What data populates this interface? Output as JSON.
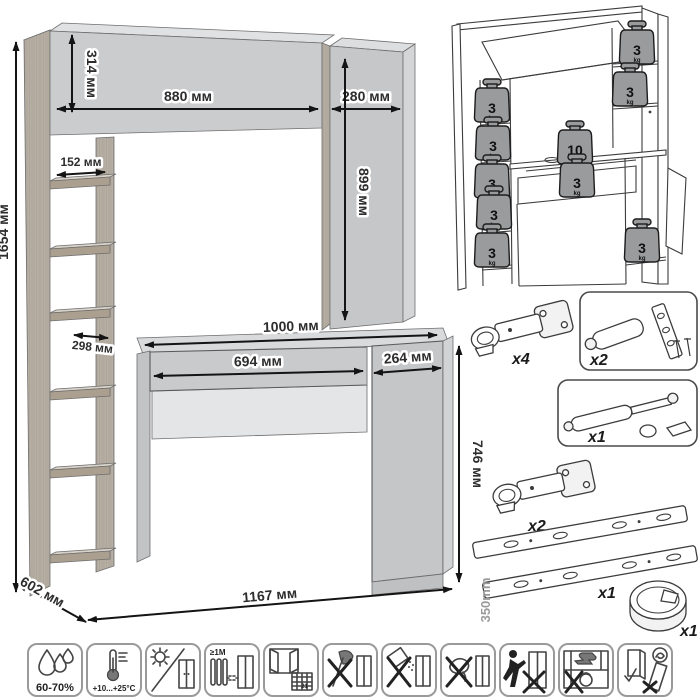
{
  "dimension_diagram": {
    "labels": {
      "total_height": "1654 мм",
      "bridge_height": "314 мм",
      "bridge_width": "880 мм",
      "right_cabinet_width": "280 мм",
      "right_cabinet_height": "899 мм",
      "shelf_width": "152 мм",
      "desktop_width": "1000 мм",
      "shelf_depth": "298 мм",
      "drawer_width": "694 мм",
      "pedestal_width": "264 мм",
      "desk_height": "746 мм",
      "depth": "602 мм",
      "total_width": "1167 мм"
    }
  },
  "load_diagram": {
    "weights": [
      {
        "value": "3",
        "unit": "kg"
      },
      {
        "value": "3",
        "unit": "kg"
      },
      {
        "value": "3",
        "unit": "kg"
      },
      {
        "value": "3",
        "unit": "kg"
      },
      {
        "value": "3",
        "unit": "kg"
      },
      {
        "value": "3",
        "unit": "kg"
      },
      {
        "value": "3",
        "unit": "kg"
      },
      {
        "value": "10",
        "unit": "kg"
      },
      {
        "value": "3",
        "unit": "kg"
      },
      {
        "value": "3",
        "unit": "kg"
      }
    ]
  },
  "hardware": {
    "items": [
      {
        "id": "hinge-top",
        "qty": "x4"
      },
      {
        "id": "door-damper",
        "qty": "x2"
      },
      {
        "id": "gas-lift",
        "qty": "x1"
      },
      {
        "id": "hinge-bottom",
        "qty": "x2"
      },
      {
        "id": "drawer-slides",
        "qty": "x1",
        "length": "350mm"
      },
      {
        "id": "cable-grommet",
        "qty": "x1"
      }
    ]
  },
  "care_icons": [
    {
      "id": "humidity",
      "label": "60-70%"
    },
    {
      "id": "temperature",
      "label": "+10...+25°C"
    },
    {
      "id": "no-direct-sunlight",
      "label": ""
    },
    {
      "id": "heat-distance",
      "label": "≥1М"
    },
    {
      "id": "ventilation",
      "label": "21"
    },
    {
      "id": "no-sharp-impact",
      "label": ""
    },
    {
      "id": "no-abrasives",
      "label": ""
    },
    {
      "id": "no-wet-cleaning",
      "label": ""
    },
    {
      "id": "no-dragging",
      "label": ""
    },
    {
      "id": "no-overloading",
      "label": ""
    },
    {
      "id": "transport-upright",
      "label": ""
    }
  ]
}
